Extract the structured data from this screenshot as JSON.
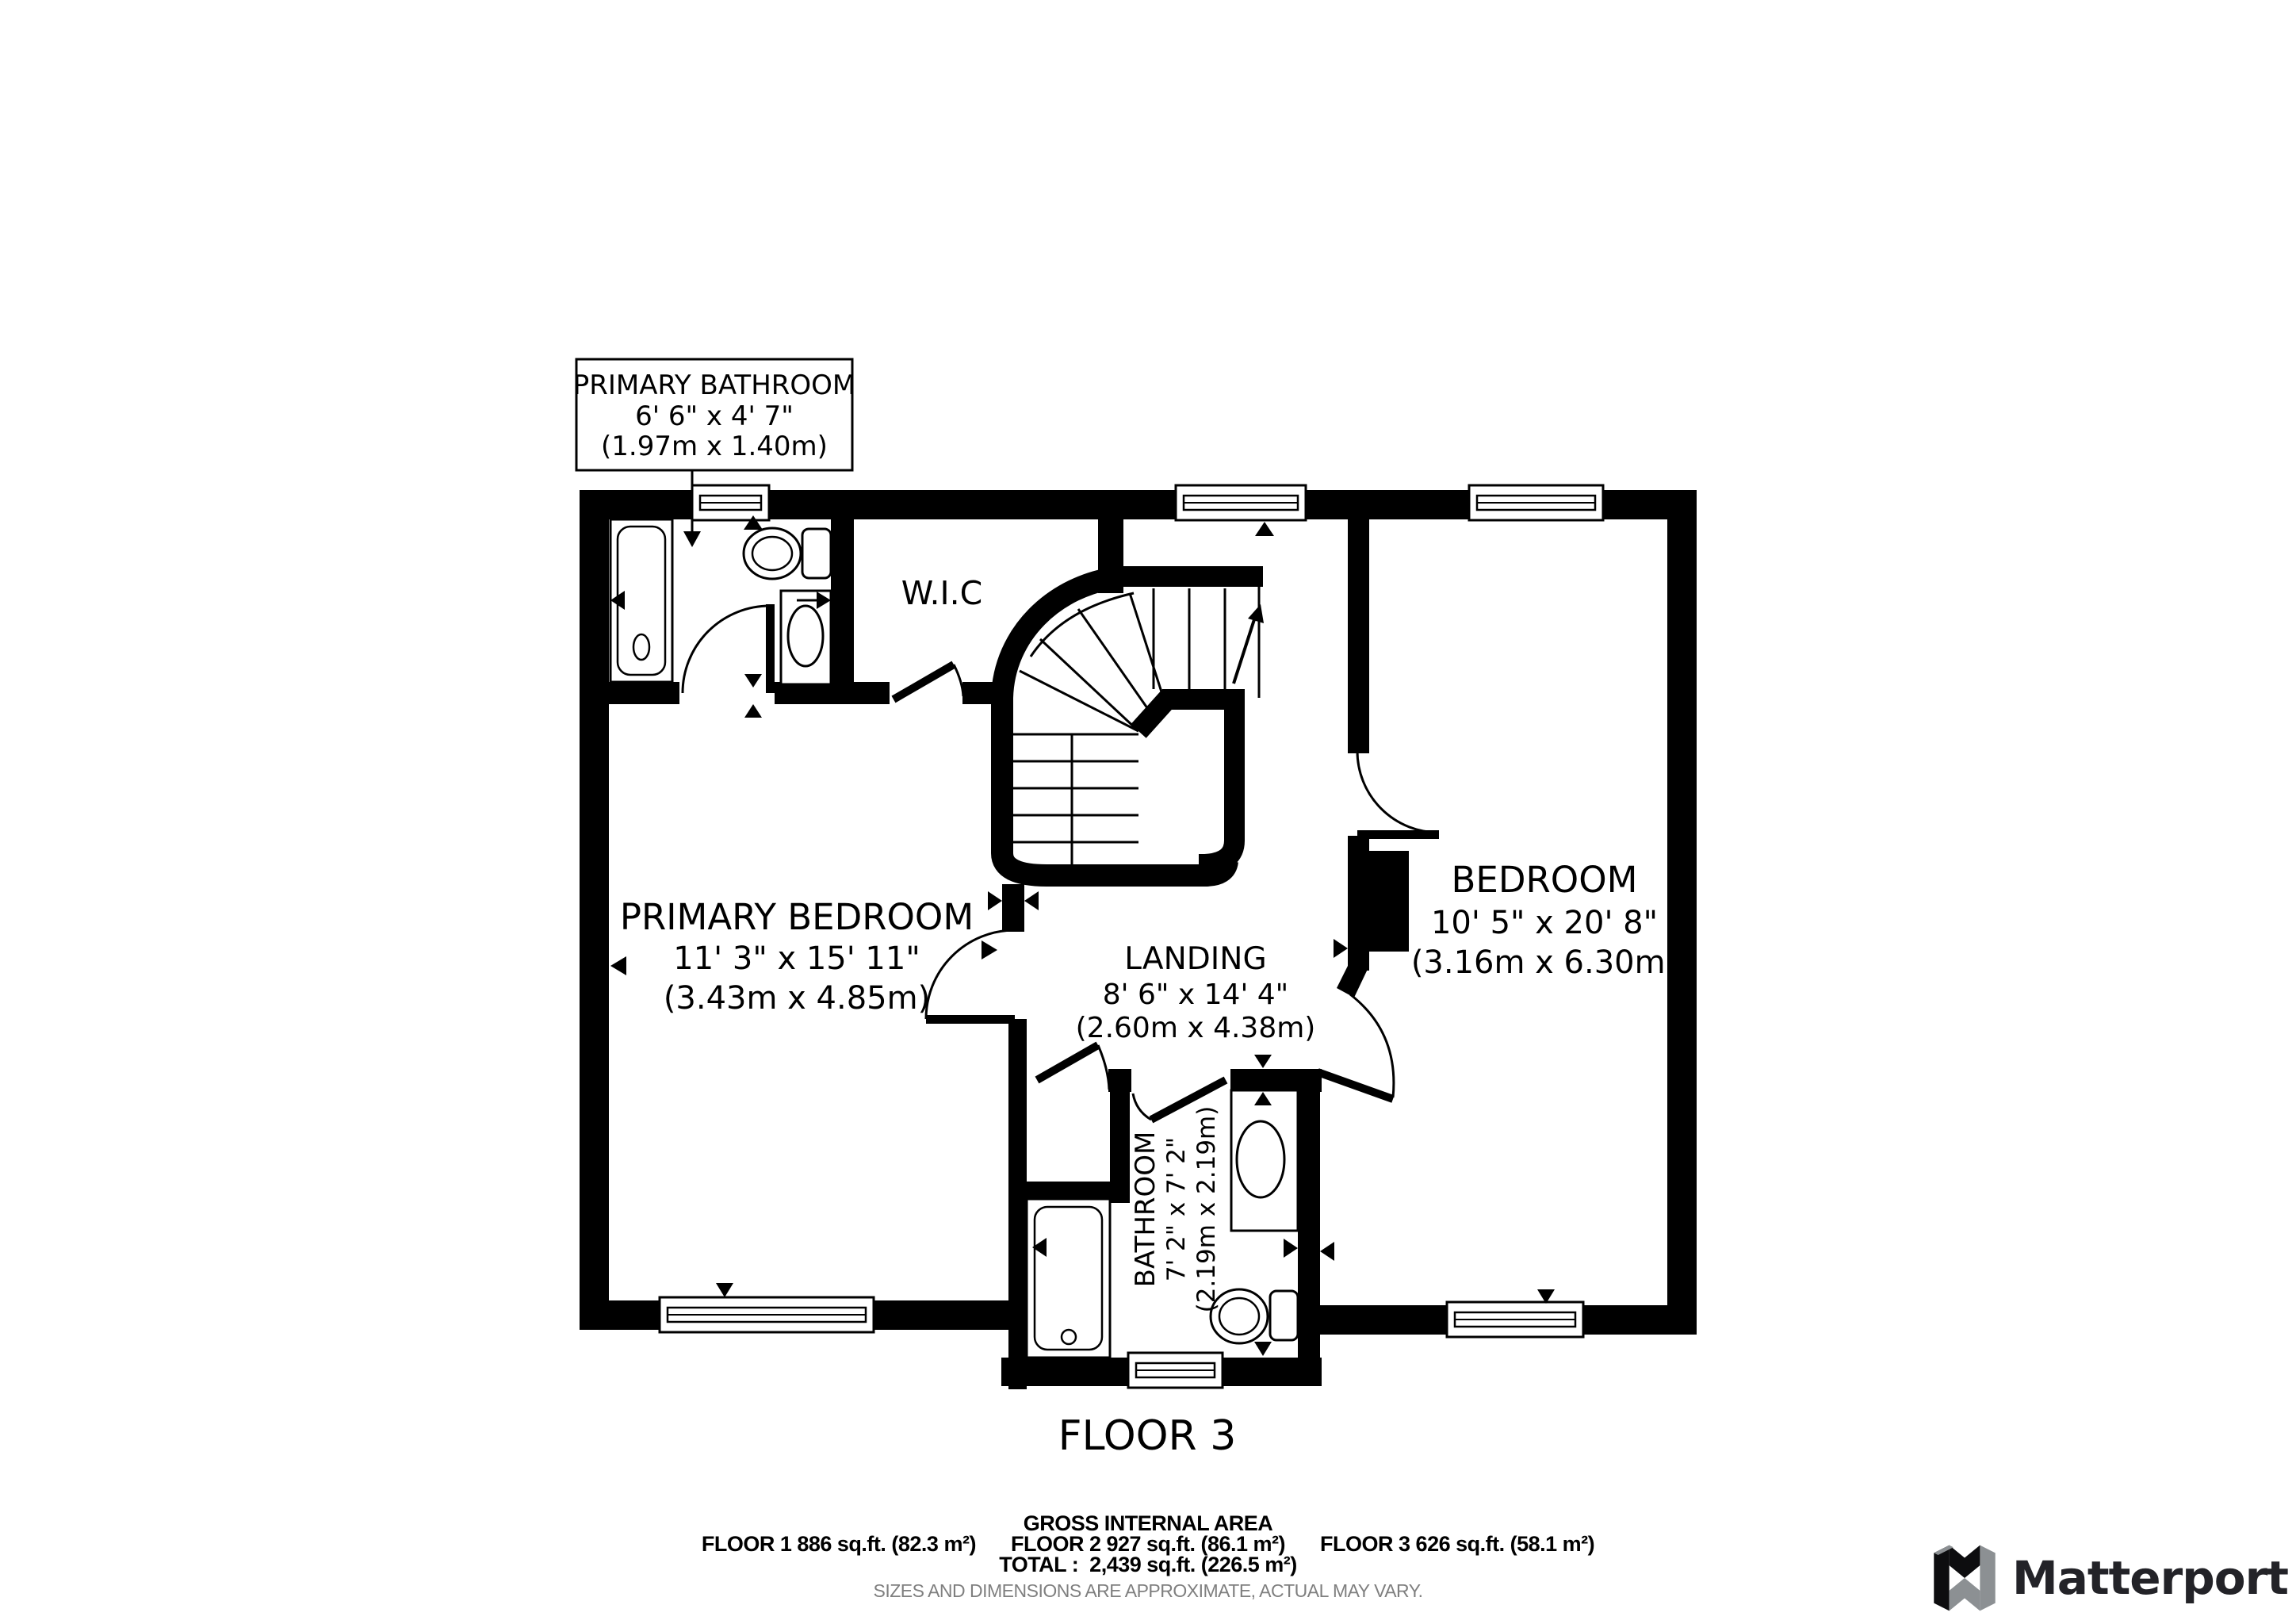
{
  "floor_plan": {
    "floor_label": "FLOOR 3",
    "rooms": {
      "primary_bathroom": {
        "name": "PRIMARY BATHROOM",
        "dims": "6' 6\" x 4' 7\"",
        "metric": "(1.97m x 1.40m)"
      },
      "wic": {
        "name": "W.I.C"
      },
      "primary_bedroom": {
        "name": "PRIMARY BEDROOM",
        "dims": "11' 3\" x 15' 11\"",
        "metric": "(3.43m x 4.85m)"
      },
      "landing": {
        "name": "LANDING",
        "dims": "8' 6\" x 14' 4\"",
        "metric": "(2.60m x 4.38m)"
      },
      "bedroom": {
        "name": "BEDROOM",
        "dims": "10' 5\" x 20' 8\"",
        "metric": "(3.16m x 6.30m)"
      },
      "bathroom": {
        "name": "BATHROOM",
        "dims": "7' 2\" x 7' 2\"",
        "metric": "(2.19m x 2.19m)"
      }
    },
    "wall_color": "#000000",
    "floor_color": "#ffffff"
  },
  "footer": {
    "gross_title": "GROSS INTERNAL AREA",
    "floor1": "FLOOR 1 886 sq.ft. (82.3 m²)",
    "floor2": "FLOOR 2 927 sq.ft. (86.1 m²)",
    "floor3": "FLOOR 3 626 sq.ft. (58.1 m²)",
    "total_line": "TOTAL :  2,439 sq.ft. (226.5 m²)",
    "disclaimer": "SIZES AND DIMENSIONS ARE APPROXIMATE, ACTUAL MAY VARY.",
    "disclaimer_color": "#7f7f7f"
  },
  "brand": {
    "name": "Matterport",
    "wordmark_color": "#232328",
    "mark_black": "#0d0d0f",
    "mark_gray": "#8c9093"
  }
}
